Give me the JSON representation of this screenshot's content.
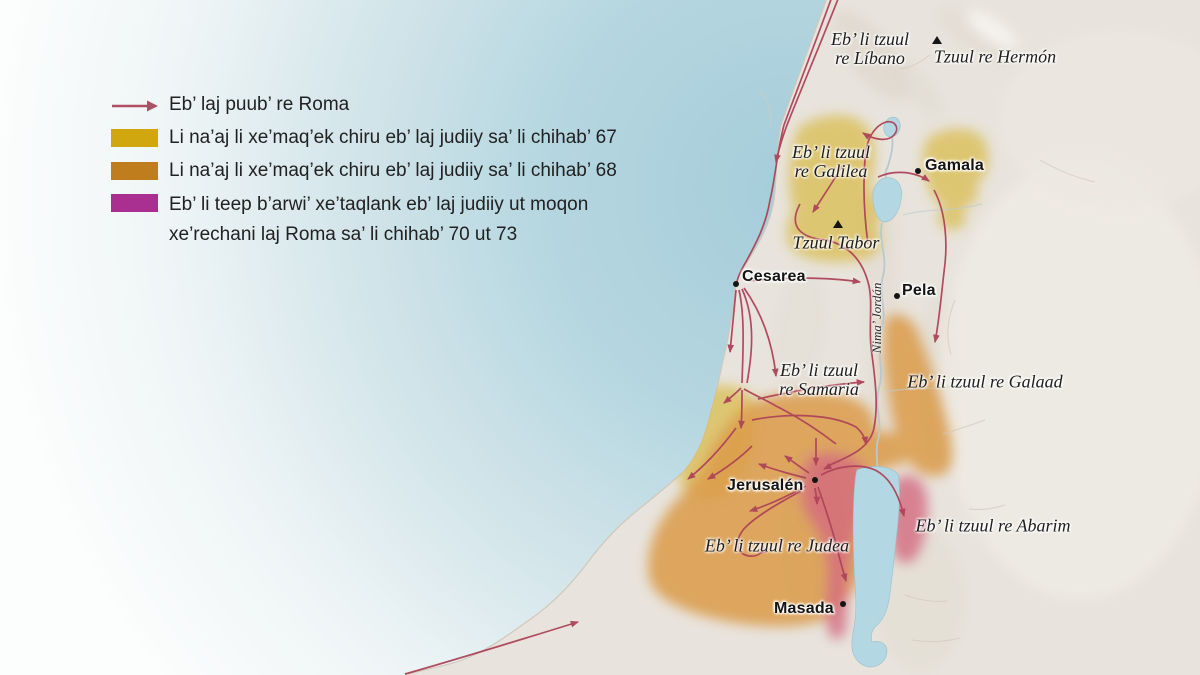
{
  "legend": {
    "arrow": {
      "label": "Eb’ laj puub’ re Roma",
      "color": "#b04f63"
    },
    "items": [
      {
        "swatch_color": "#d1a70f",
        "lines": [
          "Li na’aj li xe’maq’ek chiru eb’ laj judiiy sa’ li chihab’ 67"
        ]
      },
      {
        "swatch_color": "#c07d1e",
        "lines": [
          "Li na’aj li xe’maq’ek chiru eb’ laj judiiy sa’ li chihab’ 68"
        ]
      },
      {
        "swatch_color": "#a93090",
        "lines": [
          "Eb’ li teep b’arwi’ xe’taqlank eb’ laj judiiy ut moqon",
          "xe’rechani laj Roma sa’ li chihab’ 70 ut 73"
        ]
      }
    ]
  },
  "map": {
    "cities": [
      {
        "name": "Gamala"
      },
      {
        "name": "Cesarea"
      },
      {
        "name": "Pela"
      },
      {
        "name": "Jerusalén"
      },
      {
        "name": "Masada"
      }
    ],
    "regions": [
      {
        "id": "libano",
        "lines": [
          "Eb’ li tzuul",
          "re Líbano"
        ]
      },
      {
        "id": "hermon",
        "lines": [
          "Tzuul re Hermón"
        ]
      },
      {
        "id": "galilea",
        "lines": [
          "Eb’ li tzuul",
          "re Galilea"
        ]
      },
      {
        "id": "tabor",
        "lines": [
          "Tzuul Tabor"
        ]
      },
      {
        "id": "samaria",
        "lines": [
          "Eb’ li tzuul",
          "re Samaria"
        ]
      },
      {
        "id": "galaad",
        "lines": [
          "Eb’ li tzuul re Galaad"
        ]
      },
      {
        "id": "judea",
        "lines": [
          "Eb’ li tzuul re Judea"
        ]
      },
      {
        "id": "abarim",
        "lines": [
          "Eb’ li tzuul re Abarim"
        ]
      }
    ],
    "river_label": "Nima’ Jordán"
  },
  "colors": {
    "legend_year67": "#d1a70f",
    "legend_year68": "#c07d1e",
    "legend_year7073": "#a93090",
    "map_year67": "#d8ba4a",
    "map_year68": "#db9a49",
    "map_year7073": "#d4697f",
    "roman_arrow": "#ad4358",
    "sea": "#a5cdda",
    "lake": "#b4d8e3",
    "land": "#e8e4dd"
  }
}
